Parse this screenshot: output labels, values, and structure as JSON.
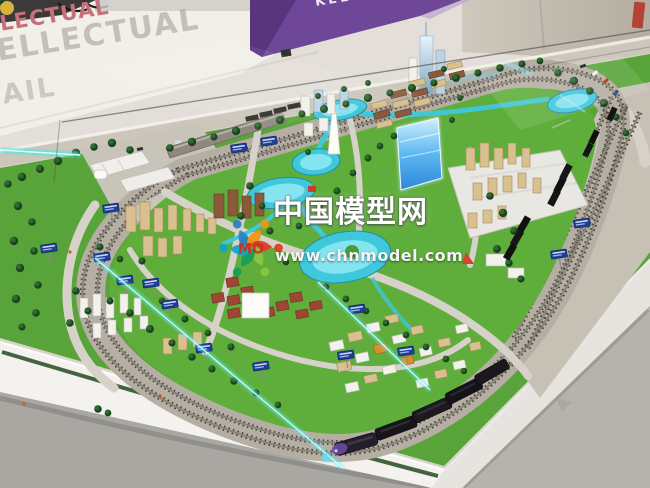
{
  "watermark": {
    "site_name": "中国模型网",
    "site_url": "www.chnmodel.com",
    "logo_text": "MO",
    "logo_colors": [
      "#2f7fc1",
      "#f09612",
      "#e23c28",
      "#8dc63f",
      "#169e57",
      "#12a5c6"
    ],
    "text_color": "#ffffff"
  },
  "wall": {
    "text_line1": "LECTUAL",
    "text_line2": "ELLECTUAL",
    "text_line3": "AIL",
    "banner_text": "KEEP",
    "wall_text_pink": "#c4717c",
    "banner_purple": "#6f4798"
  },
  "scene": {
    "subject": "architectural city scale model with model railway in exhibition display",
    "palette": {
      "grass": "#58a43a",
      "inner_grass": "#5fae3b",
      "water": "#3fc8dc",
      "led_glow": "#5ff0ff",
      "table": "#d8d4cc",
      "track_ballast": "#b5aea3",
      "train_body": "#241f2b",
      "train_nose_purple": "#6a4aa0",
      "sign_blue": "#1e3f96"
    }
  }
}
